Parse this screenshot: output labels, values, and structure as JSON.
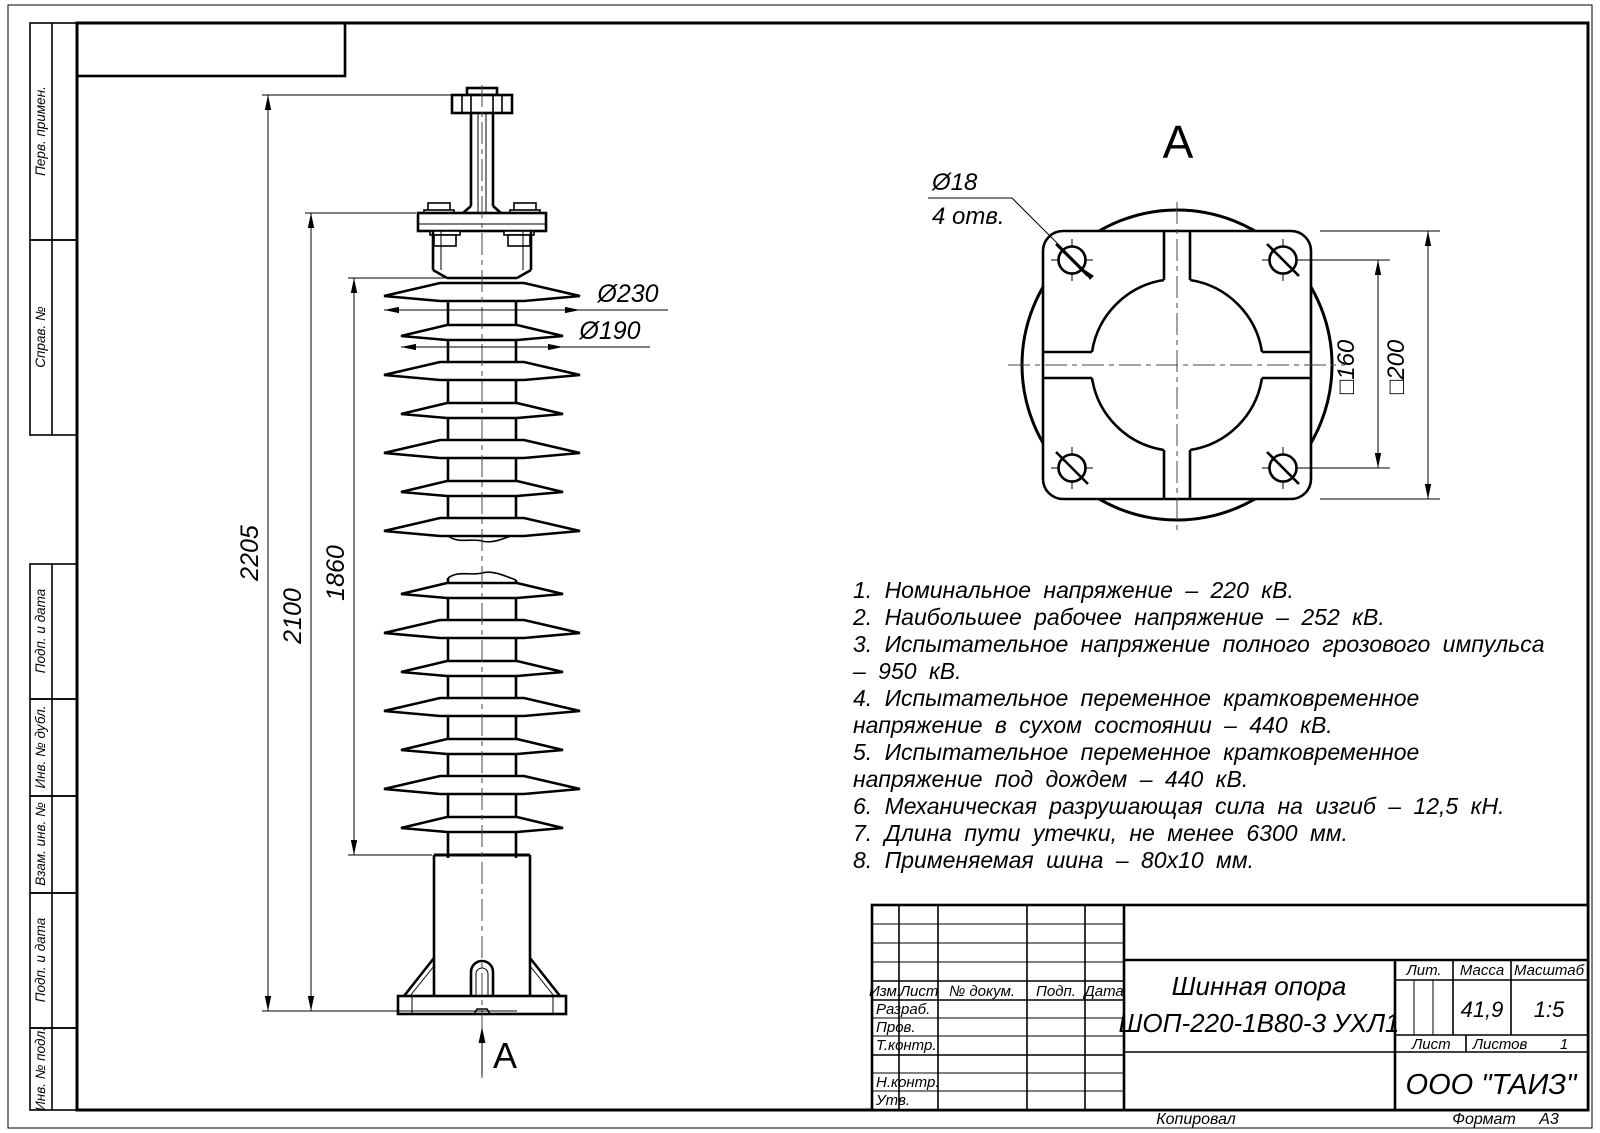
{
  "front_view": {
    "dim_2205": "2205",
    "dim_2100": "2100",
    "dim_1860": "1860",
    "dim_d230": "Ø230",
    "dim_d190": "Ø190",
    "view_label": "А"
  },
  "top_view": {
    "view_title": "А",
    "hole_dia": "Ø18",
    "hole_count": "4 отв.",
    "dim_160": "□160",
    "dim_200": "□200"
  },
  "notes": [
    "1. Номинальное напряжение – 220 кВ.",
    "2. Наибольшее рабочее напряжение – 252 кВ.",
    "3. Испытательное напряжение полного грозового импульса – 950 кВ.",
    "4. Испытательное переменное кратковременное напряжение в сухом состоянии – 440 кВ.",
    "5. Испытательное переменное кратковременное напряжение под дождем – 440 кВ.",
    "6. Механическая разрушающая сила на изгиб – 12,5 кН.",
    "7. Длина пути утечки, не менее 6300 мм.",
    "8. Применяемая шина – 80х10 мм."
  ],
  "title_block": {
    "col_izm": "Изм.",
    "col_list": "Лист",
    "col_ndoc": "№ докум.",
    "col_podp": "Подп.",
    "col_data": "Дата",
    "row_razrab": "Разраб.",
    "row_prov": "Пров.",
    "row_tkontr": "Т.контр.",
    "row_nkontr": "Н.контр.",
    "row_utv": "Утв.",
    "title_line1": "Шинная опора",
    "title_line2": "ШОП-220-1В80-3 УХЛ1",
    "lit_label": "Лит.",
    "massa_label": "Масса",
    "masshtab_label": "Масштаб",
    "massa_value": "41,9",
    "masshtab_value": "1:5",
    "list_label": "Лист",
    "listov_label": "Листов",
    "listov_value": "1",
    "company": "ООО \"ТАИЗ\""
  },
  "margin_labels": [
    "Перв. примен.",
    "Справ. №",
    "Подп. и дата",
    "Инв. № дубл.",
    "Взам. инв. №",
    "Подп. и дата",
    "Инв. № подл."
  ],
  "footer": {
    "kopiroval": "Копировал",
    "format_label": "Формат",
    "format_value": "А3"
  }
}
